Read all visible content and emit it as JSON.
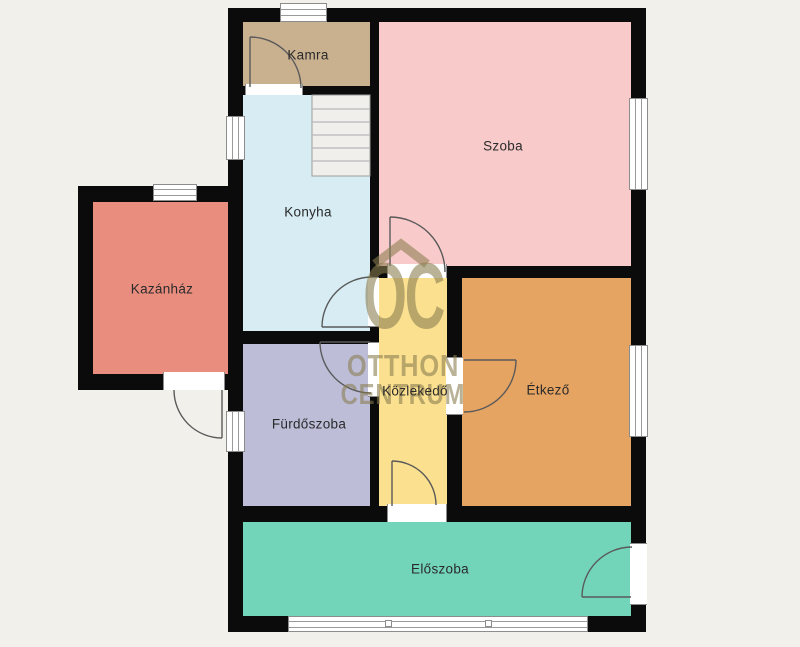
{
  "plan": {
    "type": "floor-plan",
    "language": "Hungarian"
  },
  "watermark": {
    "monogram": "OC",
    "line1": "OTTHON",
    "line2": "CENTRUM",
    "color": "#8a7c4e",
    "roof_icon_color": "#8a7c4e"
  },
  "palette": {
    "background": "#f2f0eb",
    "wall": "#0b0b0b",
    "opening_frame": "#ffffff",
    "door_arc": "#5a5a5a",
    "stairs_fill": "#f0efec"
  },
  "rooms": [
    {
      "label": "Kamra",
      "color": "#c9b190"
    },
    {
      "label": "Szoba",
      "color": "#f8caca"
    },
    {
      "label": "Konyha",
      "color": "#d7ecf3"
    },
    {
      "label": "Kazánház",
      "color": "#e98d7f"
    },
    {
      "label": "Fürdőszoba",
      "color": "#bdbdd8"
    },
    {
      "label": "Közlekedő",
      "color": "#fae08f"
    },
    {
      "label": "Étkező",
      "color": "#e6a463"
    },
    {
      "label": "Előszoba",
      "color": "#72d5ba"
    }
  ]
}
